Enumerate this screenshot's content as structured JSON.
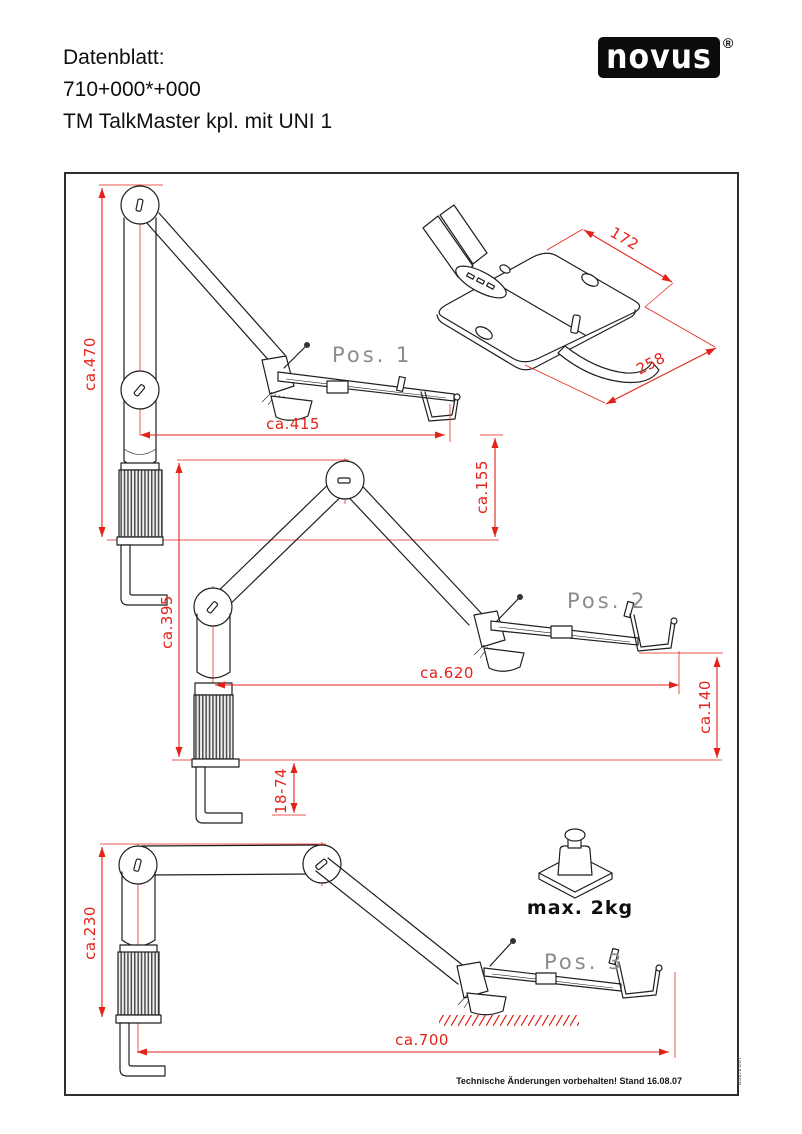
{
  "header": {
    "label": "Datenblatt:",
    "article_number": "710+000*+000",
    "product_name": "TM TalkMaster kpl. mit UNI 1"
  },
  "logo": {
    "brand": "novus",
    "registered": "®"
  },
  "colors": {
    "dimension_red": "#e32219",
    "drawing_black": "#1f1f1f",
    "position_label_gray": "#8c8c8c",
    "logo_background": "#0c0c0c"
  },
  "iso_view": {
    "dim_depth": "172",
    "dim_width": "258"
  },
  "positions": [
    {
      "label": "Pos. 1",
      "dims": {
        "height": "ca.470",
        "reach": "ca.415",
        "tray_height": "ca.155"
      }
    },
    {
      "label": "Pos. 2",
      "dims": {
        "height": "ca.395",
        "reach": "ca.620",
        "tray_drop": "ca.140",
        "clamp_range": "18-74"
      }
    },
    {
      "label": "Pos. 3",
      "dims": {
        "height": "ca.230",
        "reach": "ca.700"
      }
    }
  ],
  "load": {
    "label": "max. 2kg"
  },
  "footer": {
    "note": "Technische Änderungen vorbehalten! Stand 16.08.07",
    "doc_number": "832/2007"
  }
}
